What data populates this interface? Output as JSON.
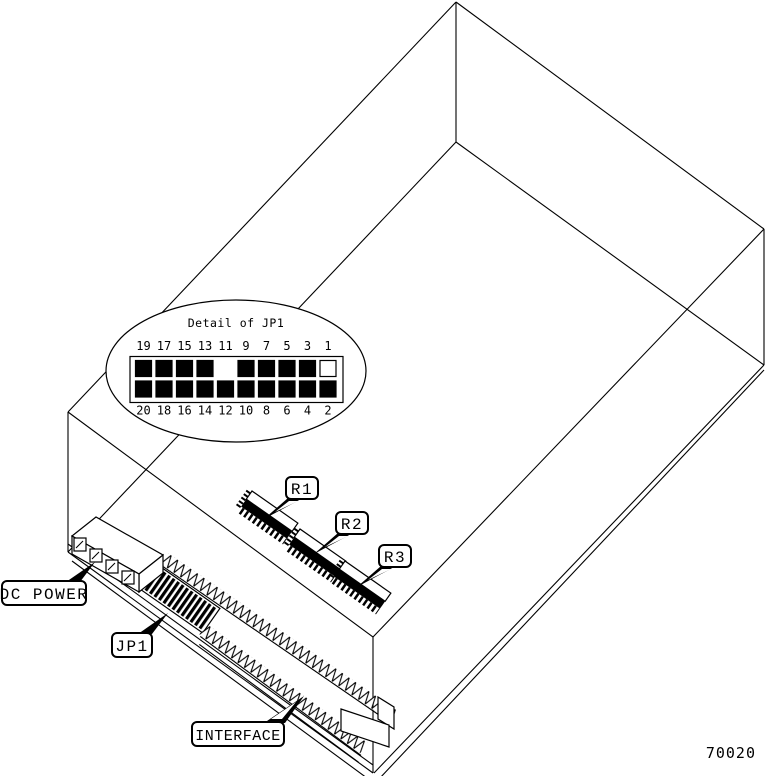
{
  "figure_number": "70020",
  "colors": {
    "line": "#000000",
    "background": "#ffffff"
  },
  "detail_callout": {
    "title": "Detail of JP1",
    "top_row": [
      {
        "label": "19",
        "state": "filled"
      },
      {
        "label": "17",
        "state": "filled"
      },
      {
        "label": "15",
        "state": "filled"
      },
      {
        "label": "13",
        "state": "filled"
      },
      {
        "label": "11",
        "state": "none"
      },
      {
        "label": "9",
        "state": "filled"
      },
      {
        "label": "7",
        "state": "filled"
      },
      {
        "label": "5",
        "state": "filled"
      },
      {
        "label": "3",
        "state": "filled"
      },
      {
        "label": "1",
        "state": "open"
      }
    ],
    "bottom_row": [
      {
        "label": "20",
        "state": "filled"
      },
      {
        "label": "18",
        "state": "filled"
      },
      {
        "label": "16",
        "state": "filled"
      },
      {
        "label": "14",
        "state": "filled"
      },
      {
        "label": "12",
        "state": "filled"
      },
      {
        "label": "10",
        "state": "filled"
      },
      {
        "label": "8",
        "state": "filled"
      },
      {
        "label": "6",
        "state": "filled"
      },
      {
        "label": "4",
        "state": "filled"
      },
      {
        "label": "2",
        "state": "filled"
      }
    ]
  },
  "callouts": {
    "dc_power": {
      "label": "DC POWER"
    },
    "jp1": {
      "label": "JP1"
    },
    "interface": {
      "label": "INTERFACE"
    },
    "r1": {
      "label": "R1"
    },
    "r2": {
      "label": "R2"
    },
    "r3": {
      "label": "R3"
    }
  }
}
